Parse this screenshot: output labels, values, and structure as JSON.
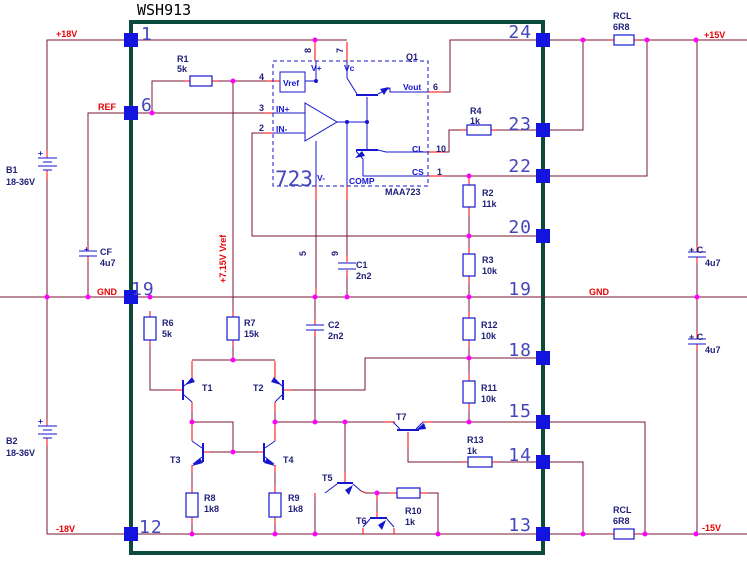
{
  "title": "WSH913",
  "rails": {
    "p18": "+18V",
    "m18": "-18V",
    "p15": "+15V",
    "m15": "-15V",
    "gnd_left": "GND",
    "gnd_right": "GND",
    "ref": "REF",
    "vref_rail": "+7.15V Vref"
  },
  "batteries": {
    "b1": {
      "name": "B1",
      "value": "18-36V",
      "plus": "+"
    },
    "b2": {
      "name": "B2",
      "value": "18-36V",
      "plus": "+"
    }
  },
  "resistors": {
    "r1": {
      "name": "R1",
      "value": "5k"
    },
    "r2": {
      "name": "R2",
      "value": "11k"
    },
    "r3": {
      "name": "R3",
      "value": "10k"
    },
    "r4": {
      "name": "R4",
      "value": "1k"
    },
    "r6": {
      "name": "R6",
      "value": "5k"
    },
    "r7": {
      "name": "R7",
      "value": "15k"
    },
    "r8": {
      "name": "R8",
      "value": "1k8"
    },
    "r9": {
      "name": "R9",
      "value": "1k8"
    },
    "r10": {
      "name": "R10",
      "value": "1k"
    },
    "r11": {
      "name": "R11",
      "value": "10k"
    },
    "r12": {
      "name": "R12",
      "value": "10k"
    },
    "r13": {
      "name": "R13",
      "value": "1k"
    },
    "rcl_top": {
      "name": "RCL",
      "value": "6R8"
    },
    "rcl_bottom": {
      "name": "RCL",
      "value": "6R8"
    }
  },
  "capacitors": {
    "c1": {
      "name": "C1",
      "value": "2n2"
    },
    "c2": {
      "name": "C2",
      "value": "2n2"
    },
    "cf": {
      "name": "CF",
      "value": "4u7",
      "plus": "+"
    },
    "c_top": {
      "name": "+ C",
      "value": "4u7"
    },
    "c_bottom": {
      "name": "+ C",
      "value": "4u7"
    }
  },
  "transistors": {
    "t1": "T1",
    "t2": "T2",
    "t3": "T3",
    "t4": "T4",
    "t5": "T5",
    "t6": "T6",
    "t7": "T7",
    "q1": "Q1"
  },
  "ic": {
    "big": "723",
    "part": "MAA723",
    "ports": {
      "vref": "Vref",
      "vplus": "V+",
      "vc": "Vc",
      "inp": "IN+",
      "inm": "IN-",
      "vout": "Vout",
      "cl": "CL",
      "cs": "CS",
      "vminus": "V-",
      "comp": "COMP"
    },
    "pins": {
      "p4": "4",
      "p3": "3",
      "p2": "2",
      "p8": "8",
      "p7": "7",
      "p5": "5",
      "p9": "9",
      "p6": "6",
      "p10": "10",
      "p1": "1"
    }
  },
  "module_pins": {
    "left": {
      "p1": "1",
      "p6": "6",
      "p19": "19",
      "p12": "12"
    },
    "right": {
      "p24": "24",
      "p23": "23",
      "p22": "22",
      "p20": "20",
      "p19": "19",
      "p18": "18",
      "p15": "15",
      "p14": "14",
      "p13": "13"
    }
  },
  "colors": {
    "wire": "#7A1533",
    "lead": "#FF0000",
    "component": "#1616CE",
    "label": "#1E1E78",
    "pin_text": "#4545BE",
    "net_label": "#E80000",
    "border": "#0C4B3B",
    "junction": "#FF00FF",
    "pad": "#1414E0"
  }
}
